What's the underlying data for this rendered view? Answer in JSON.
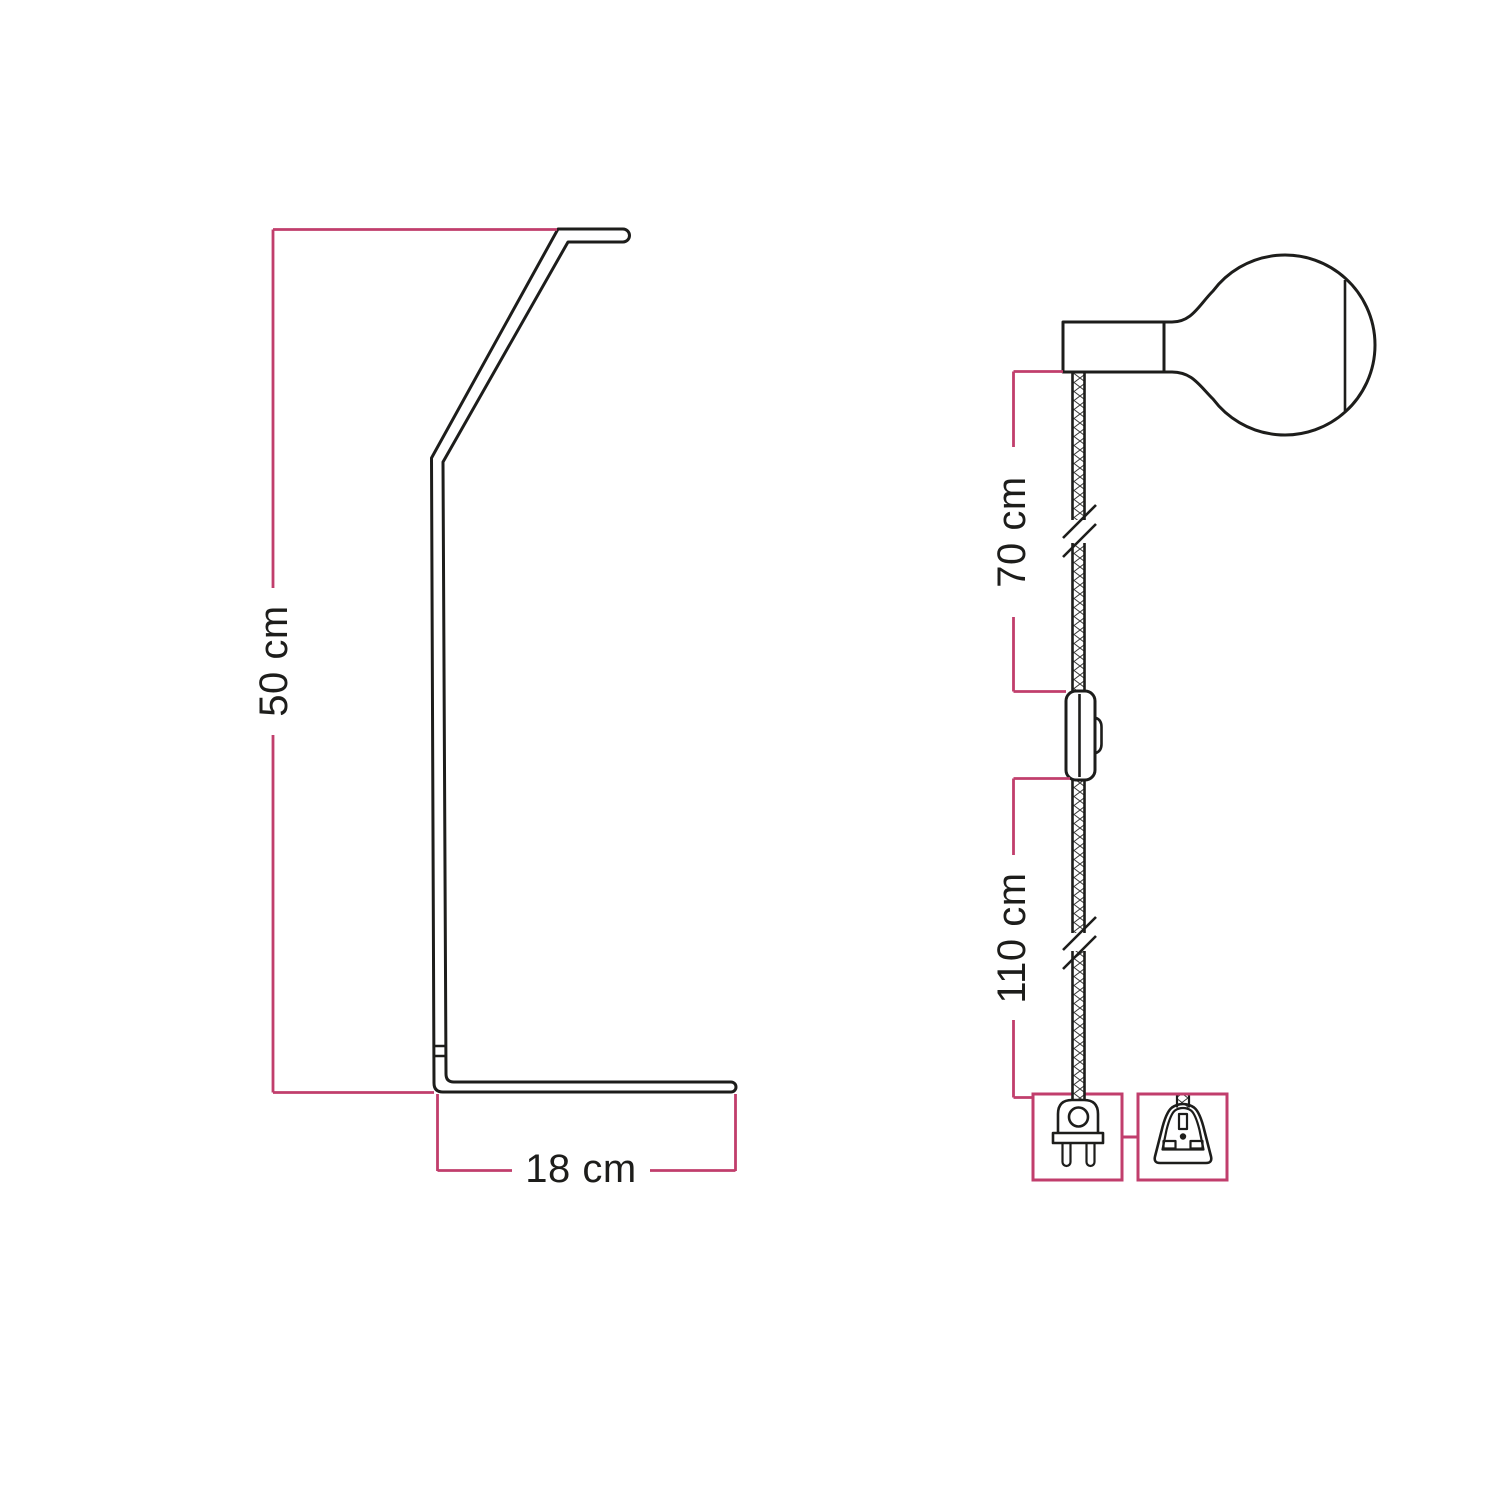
{
  "colors": {
    "accent_pink": "#c13e6c",
    "line_black": "#1d1d1b",
    "background": "#ffffff",
    "braid_hatch": "#3a3a38"
  },
  "stand_view": {
    "height_dimension": "50 cm",
    "base_dimension": "18 cm"
  },
  "pendant_view": {
    "upper_cable_dimension": "70 cm",
    "lower_cable_dimension": "110 cm",
    "icons": [
      "lamp-holder-with-globe-bulb-icon",
      "braided-cable-icon",
      "cable-break-icon",
      "inline-switch-icon",
      "eu-two-pin-plug-icon",
      "uk-three-pin-plug-icon"
    ]
  }
}
